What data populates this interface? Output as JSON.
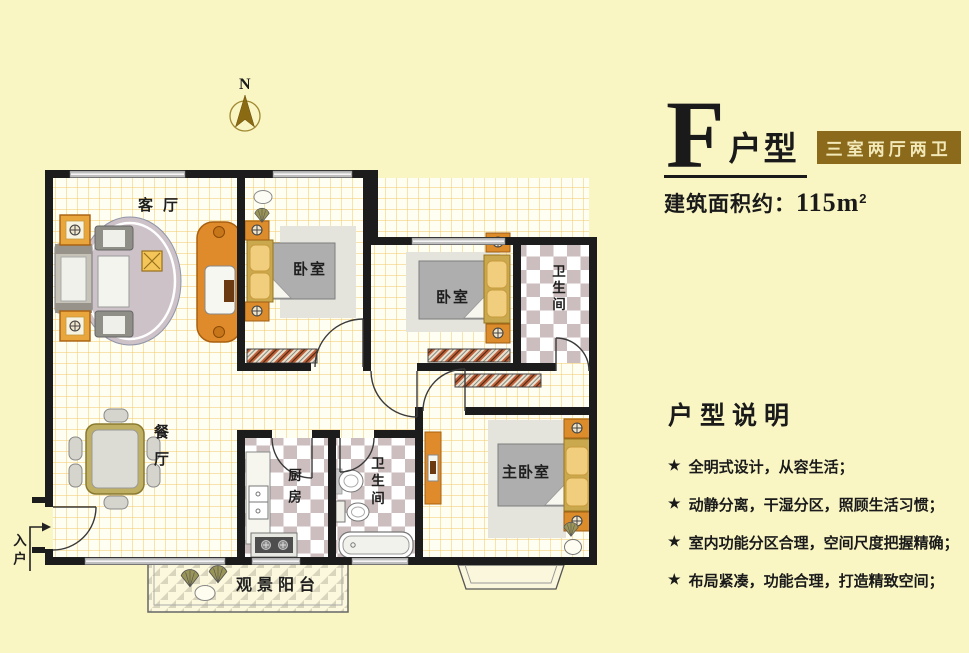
{
  "header": {
    "plan_letter": "F",
    "plan_suffix": "户型",
    "badge": "三室两厅两卫",
    "area_label": "建筑面积约：",
    "area_value": "115m",
    "area_sup": "2"
  },
  "description": {
    "heading": "户型说明",
    "bullet": "★",
    "items": [
      "全明式设计，从容生活；",
      "动静分离，干湿分区，照顾生活习惯；",
      "室内功能分区合理，空间尺度把握精确；",
      "布局紧凑，功能合理，打造精致空间；"
    ]
  },
  "compass": {
    "label": "N"
  },
  "rooms": {
    "living": "客厅",
    "dining": "餐厅",
    "bedroom_top": "卧室",
    "bedroom_mid": "卧室",
    "master_bedroom": "主卧室",
    "bath_top": "卫生间",
    "bath_bottom": "卫生间",
    "kitchen": "厨房",
    "balcony": "观景阳台",
    "entry": "入户"
  },
  "colors": {
    "page_background": "#F9F6C4",
    "badge_background": "#8B6B1B",
    "badge_text": "#F2E8B8",
    "wall": "#1C1C1C",
    "furniture_accent": "#E08B2B",
    "tile_checker": "#CCBEBE",
    "floor_grid_line": "#F2C868"
  }
}
